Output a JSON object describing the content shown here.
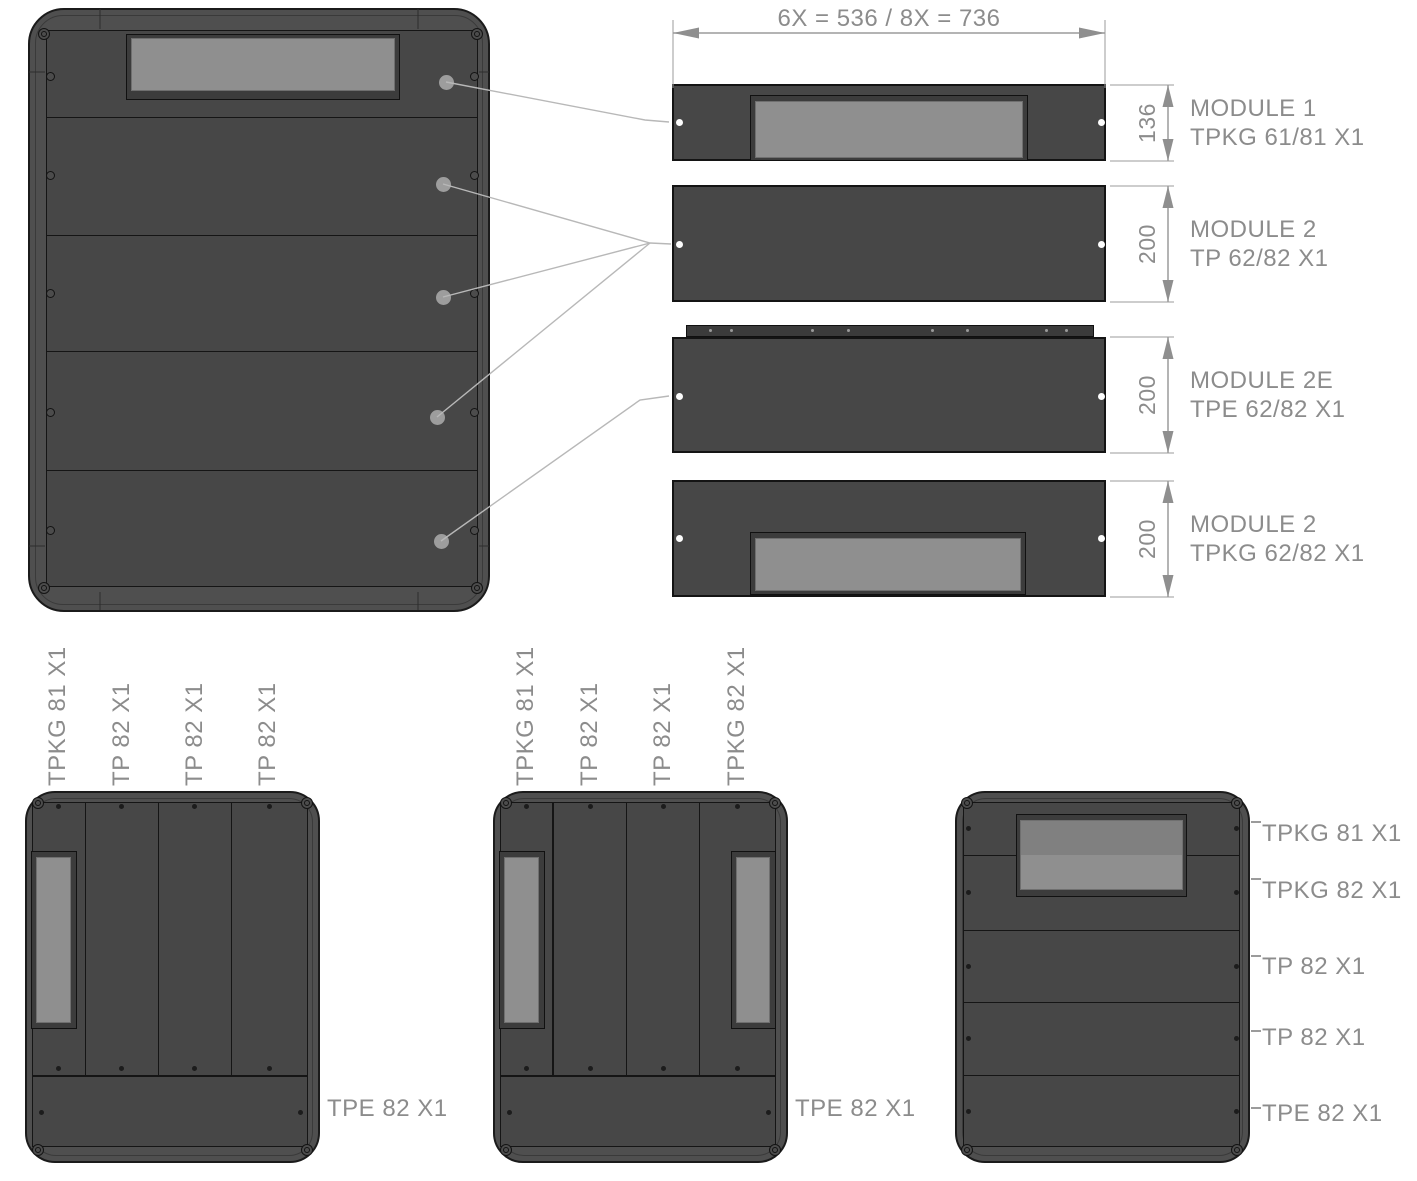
{
  "drawing": {
    "top_dimension": "6X = 536  /  8X = 736",
    "modules": [
      {
        "name": "MODULE 1",
        "part": "TPKG 61/81 X1",
        "height_dim": "136"
      },
      {
        "name": "MODULE 2",
        "part": "TP 62/82 X1",
        "height_dim": "200"
      },
      {
        "name": "MODULE 2E",
        "part": "TPE 62/82 X1",
        "height_dim": "200"
      },
      {
        "name": "MODULE 2",
        "part": "TPKG 62/82 X1",
        "height_dim": "200"
      }
    ],
    "config_a": {
      "column_labels": [
        "TPKG 81 X1",
        "TP 82 X1",
        "TP 82 X1",
        "TP 82 X1"
      ],
      "bottom_label": "TPE 82 X1"
    },
    "config_b": {
      "column_labels": [
        "TPKG 81 X1",
        "TP 82 X1",
        "TP 82 X1",
        "TPKG 82 X1"
      ],
      "bottom_label": "TPE 82 X1"
    },
    "config_c": {
      "row_labels": [
        "TPKG 81 X1",
        "TPKG 82 X1",
        "TP 82 X1",
        "TP 82 X1",
        "TPE 82 X1"
      ]
    },
    "colors": {
      "frame": "#4f4f4f",
      "panel": "#474747",
      "panel-dark": "#3c3c3c",
      "window": "#8f8f8f",
      "outline": "#181818",
      "text": "#8c8c8c",
      "line": "#9b9b9b",
      "leader": "#b8b8b8"
    }
  }
}
